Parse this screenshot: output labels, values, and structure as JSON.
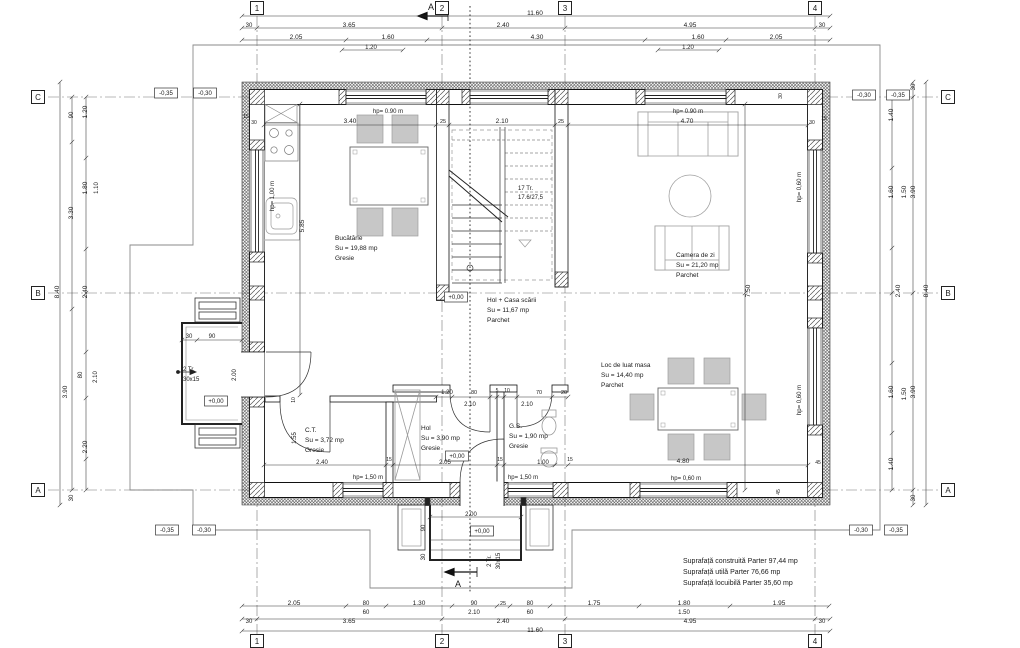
{
  "plan": {
    "section_mark": "A",
    "grid_cols": [
      "1",
      "2",
      "3",
      "4"
    ],
    "grid_rows": [
      "C",
      "B",
      "A"
    ],
    "summary": [
      "Suprafață construită Parter 97,44 mp",
      "Suprafață utilă Parter 76,66 mp",
      "Suprafață locuibilă Parter 35,60 mp"
    ],
    "rooms": [
      {
        "name": "Bucătărie",
        "area": "Su = 19,88 mp",
        "floor": "Gresie"
      },
      {
        "name": "Hol + Casa scării",
        "area": "Su = 11,67 mp",
        "floor": "Parchet"
      },
      {
        "name": "Camera de zi",
        "area": "Su = 21,20 mp",
        "floor": "Parchet"
      },
      {
        "name": "Loc de luat masa",
        "area": "Su = 14,40 mp",
        "floor": "Parchet"
      },
      {
        "name": "C.T.",
        "area": "Su = 3,72 mp",
        "floor": "Gresie"
      },
      {
        "name": "Hol",
        "area": "Su = 3,90 mp",
        "floor": "Gresie"
      },
      {
        "name": "G.S.",
        "area": "Su = 1,90 mp",
        "floor": "Gresie"
      }
    ]
  },
  "texts": [
    {
      "n": "dim-top-total",
      "t": "11.60",
      "x": 535,
      "y": 13
    },
    {
      "n": "dim-top",
      "t": "30",
      "x": 249,
      "y": 25,
      "s": 6
    },
    {
      "n": "dim-top",
      "t": "3.65",
      "x": 349,
      "y": 25
    },
    {
      "n": "dim-top",
      "t": "2.40",
      "x": 503,
      "y": 25
    },
    {
      "n": "dim-top",
      "t": "4.95",
      "x": 690,
      "y": 25
    },
    {
      "n": "dim-top",
      "t": "30",
      "x": 822,
      "y": 25,
      "s": 6
    },
    {
      "n": "dim-top",
      "t": "2.05",
      "x": 296,
      "y": 37
    },
    {
      "n": "dim-top",
      "t": "1.60",
      "x": 388,
      "y": 37
    },
    {
      "n": "dim-top",
      "t": "4.30",
      "x": 537,
      "y": 37
    },
    {
      "n": "dim-top",
      "t": "1.60",
      "x": 698,
      "y": 37
    },
    {
      "n": "dim-top",
      "t": "2.05",
      "x": 776,
      "y": 37
    },
    {
      "n": "dim-top",
      "t": "1.20",
      "x": 371,
      "y": 47,
      "s": 6
    },
    {
      "n": "dim-top",
      "t": "1.20",
      "x": 688,
      "y": 47,
      "s": 6
    },
    {
      "n": "grid-bubble-1-top",
      "t": "1",
      "x": 257,
      "y": 8,
      "b": "sq"
    },
    {
      "n": "grid-bubble-2-top",
      "t": "2",
      "x": 442,
      "y": 8,
      "b": "sq"
    },
    {
      "n": "grid-bubble-3-top",
      "t": "3",
      "x": 565,
      "y": 8,
      "b": "sq"
    },
    {
      "n": "grid-bubble-4-top",
      "t": "4",
      "x": 815,
      "y": 8,
      "b": "sq"
    },
    {
      "n": "section-label-top",
      "t": "A",
      "x": 431,
      "y": 8,
      "s": 9
    },
    {
      "n": "dim-bottom",
      "t": "2.05",
      "x": 294,
      "y": 603
    },
    {
      "n": "dim-bottom",
      "t": "80",
      "x": 366,
      "y": 603,
      "s": 6
    },
    {
      "n": "dim-bottom",
      "t": "1.30",
      "x": 419,
      "y": 603
    },
    {
      "n": "dim-bottom",
      "t": "90",
      "x": 474,
      "y": 603,
      "s": 6
    },
    {
      "n": "dim-bottom",
      "t": "25",
      "x": 503,
      "y": 603,
      "s": 5.5
    },
    {
      "n": "dim-bottom",
      "t": "80",
      "x": 530,
      "y": 603,
      "s": 6
    },
    {
      "n": "dim-bottom",
      "t": "1.75",
      "x": 594,
      "y": 603
    },
    {
      "n": "dim-bottom",
      "t": "1.80",
      "x": 684,
      "y": 603
    },
    {
      "n": "dim-bottom",
      "t": "1.95",
      "x": 779,
      "y": 603
    },
    {
      "n": "dim-bottom",
      "t": "60",
      "x": 366,
      "y": 612,
      "s": 6
    },
    {
      "n": "dim-bottom",
      "t": "2.10",
      "x": 474,
      "y": 612,
      "s": 6
    },
    {
      "n": "dim-bottom",
      "t": "60",
      "x": 530,
      "y": 612,
      "s": 6
    },
    {
      "n": "dim-bottom",
      "t": "1.50",
      "x": 684,
      "y": 612,
      "s": 6
    },
    {
      "n": "dim-bottom",
      "t": "30",
      "x": 249,
      "y": 621,
      "s": 6
    },
    {
      "n": "dim-bottom",
      "t": "3.65",
      "x": 349,
      "y": 621
    },
    {
      "n": "dim-bottom",
      "t": "2.40",
      "x": 503,
      "y": 621
    },
    {
      "n": "dim-bottom",
      "t": "4.95",
      "x": 690,
      "y": 621
    },
    {
      "n": "dim-bottom",
      "t": "30",
      "x": 822,
      "y": 621,
      "s": 6
    },
    {
      "n": "dim-bottom-total",
      "t": "11.60",
      "x": 535,
      "y": 630
    },
    {
      "n": "grid-bubble-1-bottom",
      "t": "1",
      "x": 257,
      "y": 641,
      "b": "sq"
    },
    {
      "n": "grid-bubble-2-bottom",
      "t": "2",
      "x": 442,
      "y": 641,
      "b": "sq"
    },
    {
      "n": "grid-bubble-3-bottom",
      "t": "3",
      "x": 565,
      "y": 641,
      "b": "sq"
    },
    {
      "n": "grid-bubble-4-bottom",
      "t": "4",
      "x": 815,
      "y": 641,
      "b": "sq"
    },
    {
      "n": "section-label-bottom",
      "t": "A",
      "x": 458,
      "y": 585,
      "s": 9
    },
    {
      "n": "dim-left",
      "t": "90",
      "x": 71,
      "y": 115,
      "r": -90,
      "s": 6
    },
    {
      "n": "dim-left",
      "t": "1.20",
      "x": 85,
      "y": 112,
      "r": -90
    },
    {
      "n": "dim-left",
      "t": "1.80",
      "x": 85,
      "y": 188,
      "r": -90
    },
    {
      "n": "dim-left",
      "t": "1.10",
      "x": 96,
      "y": 188,
      "r": -90,
      "s": 6
    },
    {
      "n": "dim-left",
      "t": "3.30",
      "x": 71,
      "y": 213,
      "r": -90
    },
    {
      "n": "dim-left",
      "t": "8.40",
      "x": 57,
      "y": 292,
      "r": -90
    },
    {
      "n": "dim-left",
      "t": "2.40",
      "x": 85,
      "y": 292,
      "r": -90
    },
    {
      "n": "dim-left",
      "t": "80",
      "x": 80,
      "y": 375,
      "r": -90,
      "s": 6
    },
    {
      "n": "dim-left",
      "t": "2.10",
      "x": 95,
      "y": 377,
      "r": -90,
      "s": 6
    },
    {
      "n": "dim-left",
      "t": "3.90",
      "x": 65,
      "y": 392,
      "r": -90
    },
    {
      "n": "dim-left",
      "t": "2.20",
      "x": 85,
      "y": 447,
      "r": -90
    },
    {
      "n": "dim-left",
      "t": "30",
      "x": 71,
      "y": 498,
      "r": -90,
      "s": 6
    },
    {
      "n": "grid-bubble-C-left",
      "t": "C",
      "x": 38,
      "y": 97,
      "b": "sq"
    },
    {
      "n": "grid-bubble-B-left",
      "t": "B",
      "x": 38,
      "y": 293,
      "b": "sq"
    },
    {
      "n": "grid-bubble-A-left",
      "t": "A",
      "x": 38,
      "y": 490,
      "b": "sq"
    },
    {
      "n": "level-marker",
      "t": "-0,35",
      "x": 166,
      "y": 93,
      "b": "box",
      "s": 6
    },
    {
      "n": "level-marker",
      "t": "-0,30",
      "x": 205,
      "y": 93,
      "b": "box",
      "s": 6
    },
    {
      "n": "level-marker",
      "t": "-0,35",
      "x": 167,
      "y": 530,
      "b": "box",
      "s": 6
    },
    {
      "n": "level-marker",
      "t": "-0,30",
      "x": 204,
      "y": 530,
      "b": "box",
      "s": 6
    },
    {
      "n": "dim-right",
      "t": "30",
      "x": 913,
      "y": 87,
      "r": -90,
      "s": 6
    },
    {
      "n": "dim-right",
      "t": "1.40",
      "x": 891,
      "y": 115,
      "r": -90
    },
    {
      "n": "dim-right",
      "t": "1.60",
      "x": 891,
      "y": 192,
      "r": -90
    },
    {
      "n": "dim-right",
      "t": "1.50",
      "x": 904,
      "y": 192,
      "r": -90
    },
    {
      "n": "dim-right",
      "t": "3.90",
      "x": 913,
      "y": 192,
      "r": -90
    },
    {
      "n": "dim-right",
      "t": "2.40",
      "x": 898,
      "y": 291,
      "r": -90
    },
    {
      "n": "dim-right",
      "t": "8.40",
      "x": 926,
      "y": 291,
      "r": -90
    },
    {
      "n": "dim-right",
      "t": "1.60",
      "x": 891,
      "y": 392,
      "r": -90
    },
    {
      "n": "dim-right",
      "t": "1.50",
      "x": 904,
      "y": 394,
      "r": -90
    },
    {
      "n": "dim-right",
      "t": "3.90",
      "x": 913,
      "y": 392,
      "r": -90
    },
    {
      "n": "dim-right",
      "t": "1.40",
      "x": 891,
      "y": 464,
      "r": -90
    },
    {
      "n": "dim-right",
      "t": "30",
      "x": 913,
      "y": 498,
      "r": -90,
      "s": 6
    },
    {
      "n": "grid-bubble-C-right",
      "t": "C",
      "x": 948,
      "y": 97,
      "b": "sq"
    },
    {
      "n": "grid-bubble-B-right",
      "t": "B",
      "x": 948,
      "y": 293,
      "b": "sq"
    },
    {
      "n": "grid-bubble-A-right",
      "t": "A",
      "x": 948,
      "y": 490,
      "b": "sq"
    },
    {
      "n": "level-marker",
      "t": "-0,30",
      "x": 864,
      "y": 95,
      "b": "box",
      "s": 6
    },
    {
      "n": "level-marker",
      "t": "-0,35",
      "x": 898,
      "y": 95,
      "b": "box",
      "s": 6
    },
    {
      "n": "level-marker",
      "t": "-0,30",
      "x": 861,
      "y": 530,
      "b": "box",
      "s": 6
    },
    {
      "n": "level-marker",
      "t": "-0,35",
      "x": 896,
      "y": 530,
      "b": "box",
      "s": 6
    },
    {
      "n": "dim-room",
      "t": "3.40",
      "x": 350,
      "y": 121
    },
    {
      "n": "dim-room",
      "t": "25",
      "x": 443,
      "y": 121,
      "s": 5.5
    },
    {
      "n": "dim-room",
      "t": "2.10",
      "x": 502,
      "y": 121
    },
    {
      "n": "dim-room",
      "t": "25",
      "x": 561,
      "y": 121,
      "s": 5.5
    },
    {
      "n": "dim-room",
      "t": "4.70",
      "x": 687,
      "y": 121
    },
    {
      "n": "dim-wall",
      "t": "15",
      "x": 246,
      "y": 116,
      "s": 5
    },
    {
      "n": "dim-wall",
      "t": "30",
      "x": 254,
      "y": 122,
      "s": 5
    },
    {
      "n": "dim-wall",
      "t": "30",
      "x": 780,
      "y": 96,
      "r": -90,
      "s": 5
    },
    {
      "n": "dim-wall",
      "t": "30",
      "x": 812,
      "y": 122,
      "s": 5
    },
    {
      "n": "dim-wall",
      "t": "15",
      "x": 824,
      "y": 118,
      "s": 5
    },
    {
      "n": "hp-label",
      "t": "hp= 0.90 m",
      "x": 388,
      "y": 111,
      "s": 6
    },
    {
      "n": "hp-label",
      "t": "hp= 0.90 m",
      "x": 688,
      "y": 111,
      "s": 6
    },
    {
      "n": "hp-label",
      "t": "hp= 1,00 m",
      "x": 272,
      "y": 196,
      "r": -90,
      "s": 6
    },
    {
      "n": "hp-label",
      "t": "hp= 0,60 m",
      "x": 799,
      "y": 187,
      "r": -90,
      "s": 6
    },
    {
      "n": "hp-label",
      "t": "hp= 0,60 m",
      "x": 799,
      "y": 400,
      "r": -90,
      "s": 6
    },
    {
      "n": "hp-label",
      "t": "hp= 1,50 m",
      "x": 368,
      "y": 477,
      "s": 6
    },
    {
      "n": "hp-label",
      "t": "hp= 1,50 m",
      "x": 523,
      "y": 477,
      "s": 6
    },
    {
      "n": "hp-label",
      "t": "hp= 0,60 m",
      "x": 686,
      "y": 478,
      "s": 6
    },
    {
      "n": "dim-room",
      "t": "5.85",
      "x": 302,
      "y": 226,
      "r": -90
    },
    {
      "n": "dim-room",
      "t": "7.50",
      "x": 748,
      "y": 291,
      "r": -90
    },
    {
      "n": "room-name-bucatarie",
      "t": "Bucătărie",
      "x": 335,
      "y": 238,
      "a": "start"
    },
    {
      "n": "room-area",
      "t": "Su = 19,88 mp",
      "x": 335,
      "y": 248,
      "a": "start"
    },
    {
      "n": "room-floor",
      "t": "Gresie",
      "x": 335,
      "y": 258,
      "a": "start"
    },
    {
      "n": "room-name-hol-scara",
      "t": "Hol + Casa scării",
      "x": 487,
      "y": 300,
      "a": "start"
    },
    {
      "n": "room-area",
      "t": "Su = 11,67 mp",
      "x": 487,
      "y": 310,
      "a": "start"
    },
    {
      "n": "room-floor",
      "t": "Parchet",
      "x": 487,
      "y": 320,
      "a": "start"
    },
    {
      "n": "room-name-camera-zi",
      "t": "Camera de zi",
      "x": 676,
      "y": 255,
      "a": "start"
    },
    {
      "n": "room-area",
      "t": "Su = 21,20 mp",
      "x": 676,
      "y": 265,
      "a": "start"
    },
    {
      "n": "room-floor",
      "t": "Parchet",
      "x": 676,
      "y": 275,
      "a": "start"
    },
    {
      "n": "room-name-dining",
      "t": "Loc de luat masa",
      "x": 601,
      "y": 365,
      "a": "start"
    },
    {
      "n": "room-area",
      "t": "Su = 14,40 mp",
      "x": 601,
      "y": 375,
      "a": "start"
    },
    {
      "n": "room-floor",
      "t": "Parchet",
      "x": 601,
      "y": 385,
      "a": "start"
    },
    {
      "n": "room-name-ct",
      "t": "C.T.",
      "x": 305,
      "y": 430,
      "a": "start"
    },
    {
      "n": "room-area",
      "t": "Su = 3,72 mp",
      "x": 305,
      "y": 440,
      "a": "start"
    },
    {
      "n": "room-floor",
      "t": "Gresie",
      "x": 305,
      "y": 450,
      "a": "start"
    },
    {
      "n": "room-name-hol",
      "t": "Hol",
      "x": 421,
      "y": 428,
      "a": "start"
    },
    {
      "n": "room-area",
      "t": "Su = 3,90 mp",
      "x": 421,
      "y": 438,
      "a": "start"
    },
    {
      "n": "room-floor",
      "t": "Gresie",
      "x": 421,
      "y": 448,
      "a": "start"
    },
    {
      "n": "room-name-gs",
      "t": "G.S.",
      "x": 509,
      "y": 426,
      "a": "start"
    },
    {
      "n": "room-area",
      "t": "Su = 1,90 mp",
      "x": 509,
      "y": 436,
      "a": "start"
    },
    {
      "n": "room-floor",
      "t": "Gresie",
      "x": 509,
      "y": 446,
      "a": "start"
    },
    {
      "n": "stair-label",
      "t": "17 Tr.",
      "x": 518,
      "y": 188,
      "a": "start",
      "s": 6
    },
    {
      "n": "stair-label",
      "t": "17.6/27,5",
      "x": 518,
      "y": 197,
      "a": "start",
      "s": 6
    },
    {
      "n": "level-marker",
      "t": "+0,00",
      "x": 456,
      "y": 297,
      "b": "box",
      "s": 6
    },
    {
      "n": "level-marker",
      "t": "+0,00",
      "x": 457,
      "y": 456,
      "b": "box",
      "s": 6
    },
    {
      "n": "level-marker",
      "t": "+0,00",
      "x": 216,
      "y": 401,
      "b": "box",
      "s": 6
    },
    {
      "n": "level-marker",
      "t": "+0,00",
      "x": 482,
      "y": 531,
      "b": "box",
      "s": 6
    },
    {
      "n": "dim-partition",
      "t": "1.20",
      "x": 447,
      "y": 392,
      "s": 6
    },
    {
      "n": "dim-partition",
      "t": "80",
      "x": 474,
      "y": 392,
      "s": 5.5
    },
    {
      "n": "dim-partition",
      "t": "5",
      "x": 497,
      "y": 390,
      "s": 5
    },
    {
      "n": "dim-partition",
      "t": "10",
      "x": 507,
      "y": 390,
      "s": 5
    },
    {
      "n": "dim-partition",
      "t": "70",
      "x": 539,
      "y": 392,
      "s": 5.5
    },
    {
      "n": "dim-partition",
      "t": "20",
      "x": 564,
      "y": 392,
      "s": 5.5
    },
    {
      "n": "dim-partition",
      "t": "2.10",
      "x": 470,
      "y": 404,
      "s": 6
    },
    {
      "n": "dim-partition",
      "t": "2.10",
      "x": 527,
      "y": 404,
      "s": 6
    },
    {
      "n": "dim-partition",
      "t": "2.40",
      "x": 322,
      "y": 462,
      "s": 6
    },
    {
      "n": "dim-partition",
      "t": "15",
      "x": 389,
      "y": 459,
      "s": 5
    },
    {
      "n": "dim-partition",
      "t": "2.05",
      "x": 445,
      "y": 462,
      "s": 6
    },
    {
      "n": "dim-partition",
      "t": "15",
      "x": 500,
      "y": 459,
      "s": 5
    },
    {
      "n": "dim-partition",
      "t": "1.00",
      "x": 543,
      "y": 462,
      "s": 6
    },
    {
      "n": "dim-partition",
      "t": "15",
      "x": 570,
      "y": 459,
      "s": 5
    },
    {
      "n": "dim-partition",
      "t": "1.55",
      "x": 294,
      "y": 438,
      "r": -90,
      "s": 6
    },
    {
      "n": "dim-partition",
      "t": "10",
      "x": 293,
      "y": 400,
      "r": -90,
      "s": 5
    },
    {
      "n": "dim-partition",
      "t": "4.80",
      "x": 683,
      "y": 461
    },
    {
      "n": "dim-wall",
      "t": "45",
      "x": 818,
      "y": 462,
      "s": 5
    },
    {
      "n": "dim-wall",
      "t": "45",
      "x": 778,
      "y": 492,
      "r": -90,
      "s": 5
    },
    {
      "n": "porch-left-dim",
      "t": "30",
      "x": 189,
      "y": 336,
      "s": 6
    },
    {
      "n": "porch-left-dim",
      "t": "90",
      "x": 212,
      "y": 336,
      "s": 6
    },
    {
      "n": "porch-left-dim",
      "t": "2.00",
      "x": 234,
      "y": 375,
      "r": -90,
      "s": 6
    },
    {
      "n": "porch-left-steps",
      "t": "2 Tr.",
      "x": 183,
      "y": 369,
      "a": "start",
      "s": 6
    },
    {
      "n": "porch-left-steps",
      "t": "30x15",
      "x": 183,
      "y": 379,
      "a": "start",
      "s": 6
    },
    {
      "n": "porch-bottom-dim",
      "t": "2.00",
      "x": 471,
      "y": 514,
      "s": 6
    },
    {
      "n": "porch-bottom-dim",
      "t": "90",
      "x": 423,
      "y": 528,
      "r": -90,
      "s": 6
    },
    {
      "n": "porch-bottom-dim",
      "t": "30",
      "x": 423,
      "y": 557,
      "r": -90,
      "s": 6
    },
    {
      "n": "porch-bottom-steps",
      "t": "2 Tr.",
      "x": 489,
      "y": 561,
      "r": -90,
      "s": 6
    },
    {
      "n": "porch-bottom-steps",
      "t": "30x15",
      "x": 498,
      "y": 561,
      "r": -90,
      "s": 6
    },
    {
      "n": "summary-line-1",
      "t": "Suprafață construită Parter 97,44 mp",
      "x": 683,
      "y": 561,
      "a": "start",
      "s": 7
    },
    {
      "n": "summary-line-2",
      "t": "Suprafață utilă Parter 76,66 mp",
      "x": 683,
      "y": 572,
      "a": "start",
      "s": 7
    },
    {
      "n": "summary-line-3",
      "t": "Suprafață locuibilă Parter 35,60 mp",
      "x": 683,
      "y": 583,
      "a": "start",
      "s": 7
    }
  ]
}
